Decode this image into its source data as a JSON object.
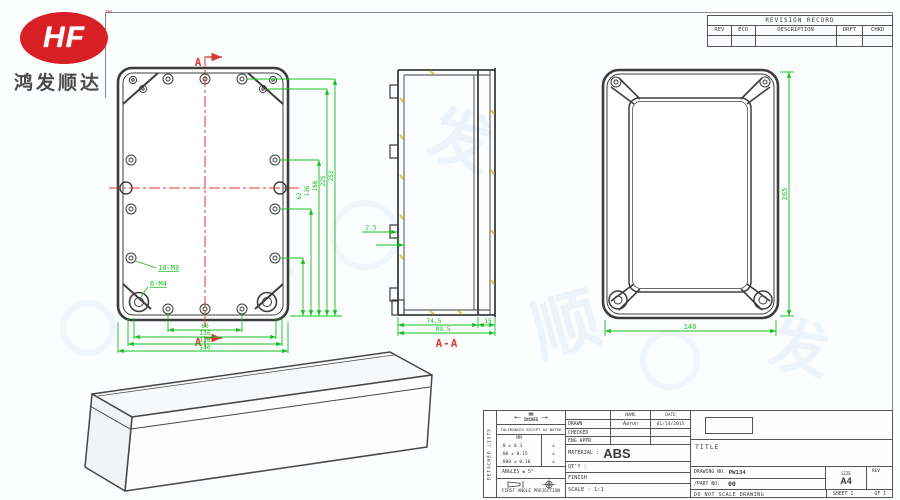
{
  "logo": {
    "monogram": "HF",
    "trademark": "™",
    "company_name": "鸿发顺达"
  },
  "watermark": {
    "glyphs": [
      "鸿",
      "发",
      "顺",
      "达",
      "顺",
      "发"
    ]
  },
  "colors": {
    "dimension_green": "#12c21c",
    "centerline_red": "#d93a2e",
    "drawing_line": "#3d3d3d",
    "hatch_yellow": "#d9c736",
    "logo_red": "#d81f24",
    "watermark_blue": "#9ec4e6"
  },
  "revision_table": {
    "title": "REVISION RECORD",
    "columns": [
      "REV",
      "ECO",
      "DESCRIPTION",
      "DRFT",
      "CHKD"
    ]
  },
  "front_view": {
    "section_letter_top": "A",
    "section_letter_bottom": "A",
    "thread_callout_small": "10-M3",
    "thread_callout_large": "6-M4",
    "bottom_dims": [
      "60",
      "116",
      "126",
      "140"
    ],
    "vertical_dims": [
      "62",
      "116",
      "166",
      "225",
      "253"
    ]
  },
  "section_view": {
    "label": "A-A",
    "dim_body": "74.5",
    "dim_lid": "15",
    "dim_total": "89.5",
    "dim_lug_offset": "2.5",
    "dim_lug": "5"
  },
  "back_view": {
    "dim_height": "265",
    "dim_width": "140"
  },
  "title_block": {
    "side_label": "DETACHED LISTS",
    "units_primary": "MM",
    "units_secondary": "INCHES",
    "tolerance_note": "TOLERANCES EXCEPT AS NOTED",
    "tol_col_header": "MM",
    "tolerances": [
      {
        "mm": ".0 ± 0.3",
        "inch": "±"
      },
      {
        "mm": ".00 ± 0.15",
        "inch": "±"
      },
      {
        "mm": ".000 ± 0.10",
        "inch": "±"
      }
    ],
    "angles": "ANGLES ± 5°",
    "projection": "FIRST ANGLE PROJECTION",
    "name_header": "NAME",
    "date_header": "DATE",
    "drawn_label": "DRAWN",
    "drawn_name": "Aaron",
    "drawn_date": "01/14/2015",
    "checked_label": "CHECKED",
    "eng_appr_label": "ENG APPR",
    "material_label": "MATERIAL :",
    "material_value": "ABS",
    "qty_label": "QT'Y :",
    "finish_label": "FINISH",
    "scale_label": "SCALE : 1:1",
    "title_label": "TITLE",
    "drawing_no_label": "DRAWING NO.",
    "drawing_no_value": "PW134",
    "part_no_label": "/PART NO.",
    "part_no_value": "00",
    "size_label": "SIZE",
    "size_value": "A4",
    "rev_label": "REV",
    "no_scale_note": "DO NOT SCALE DRAWING",
    "sheet_left": "SHEET 1",
    "sheet_right": "OF 1"
  }
}
